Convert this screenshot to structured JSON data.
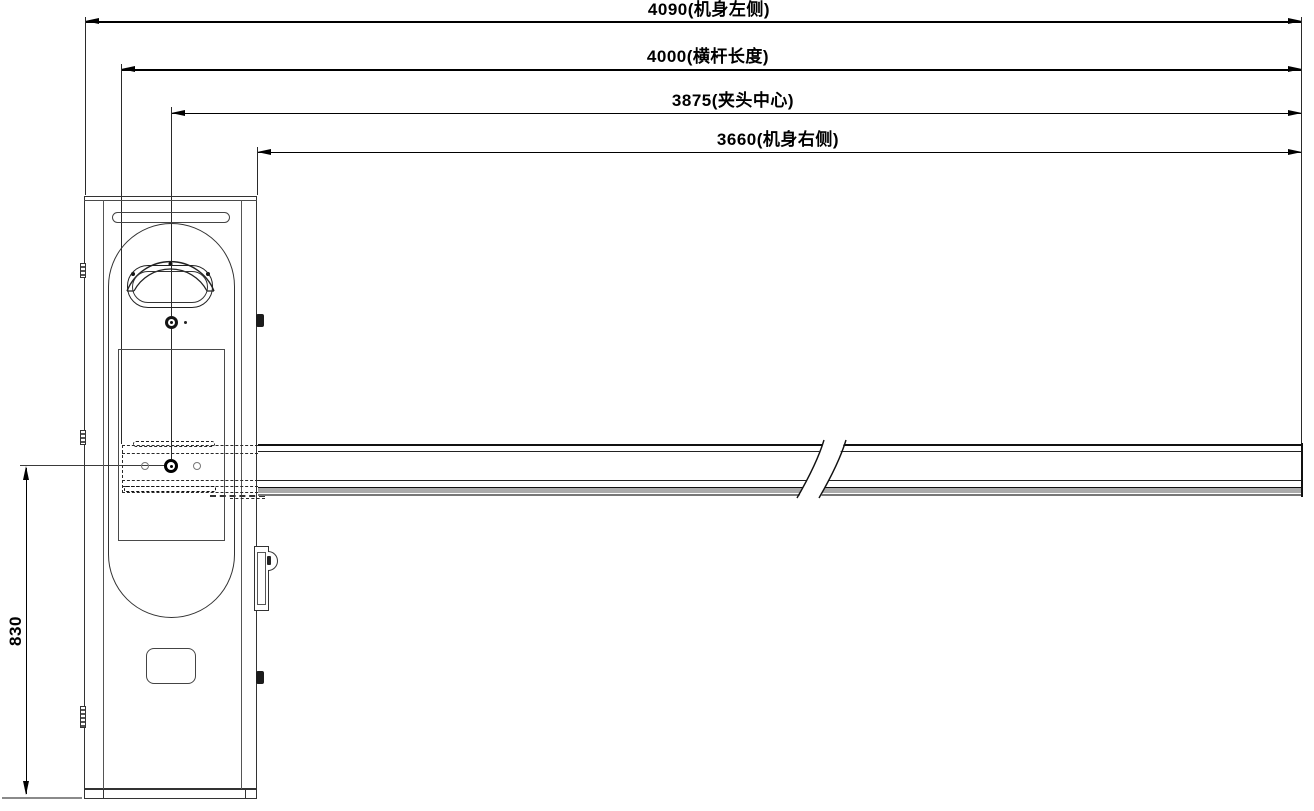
{
  "drawing": {
    "kind": "technical-drawing",
    "dimensions": {
      "top": [
        {
          "display": "4090(机身左侧)",
          "value": 4090,
          "label": "机身左侧"
        },
        {
          "display": "4000(横杆长度)",
          "value": 4000,
          "label": "横杆长度"
        },
        {
          "display": "3875(夹头中心)",
          "value": 3875,
          "label": "夹头中心"
        },
        {
          "display": "3660(机身右侧)",
          "value": 3660,
          "label": "机身右侧"
        }
      ],
      "left": {
        "display": "830",
        "value": 830
      }
    },
    "colors": {
      "background": "#ffffff",
      "line": "#2f2f2f",
      "dimension": "#000000",
      "boom_band": "#ababab"
    }
  }
}
